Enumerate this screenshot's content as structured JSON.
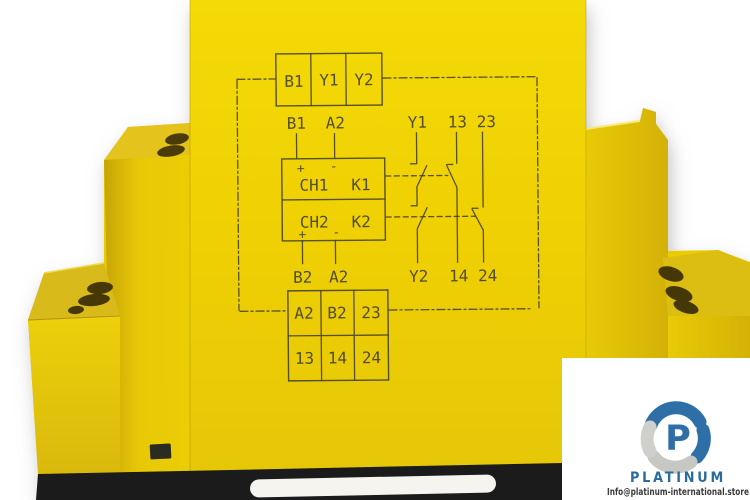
{
  "scene": {
    "background_color": "#ffffff",
    "subject": "yellow safety relay module with printed wiring schematic"
  },
  "device": {
    "body_color": "#eed103",
    "base_color": "#1b1b1b",
    "print_color": "#45422e",
    "top_terminal_row": {
      "cells": [
        "B1",
        "Y1",
        "Y2"
      ]
    },
    "schematic": {
      "input_top_labels": [
        "B1",
        "A2"
      ],
      "output_top_labels": [
        "Y1",
        "13",
        "23"
      ],
      "polarity_top": [
        "+",
        "-"
      ],
      "channel_rows": [
        {
          "channel": "CH1",
          "relay": "K1"
        },
        {
          "channel": "CH2",
          "relay": "K2"
        }
      ],
      "polarity_bottom": [
        "+",
        "-"
      ],
      "input_bottom_labels": [
        "B2",
        "A2"
      ],
      "output_bottom_labels": [
        "Y2",
        "14",
        "24"
      ]
    },
    "bottom_terminal_grid": {
      "rows": [
        [
          "A2",
          "B2",
          "23"
        ],
        [
          "13",
          "14",
          "24"
        ]
      ]
    }
  },
  "watermark": {
    "logo_letter": "P",
    "brand": "PLATINUM",
    "email": "Info@platinum-international.store",
    "brand_color": "#2a6ba0",
    "petal_blue": "#2f6fa7",
    "petal_gray": "#c7c7c3",
    "email_color": "#3c3c3c"
  }
}
